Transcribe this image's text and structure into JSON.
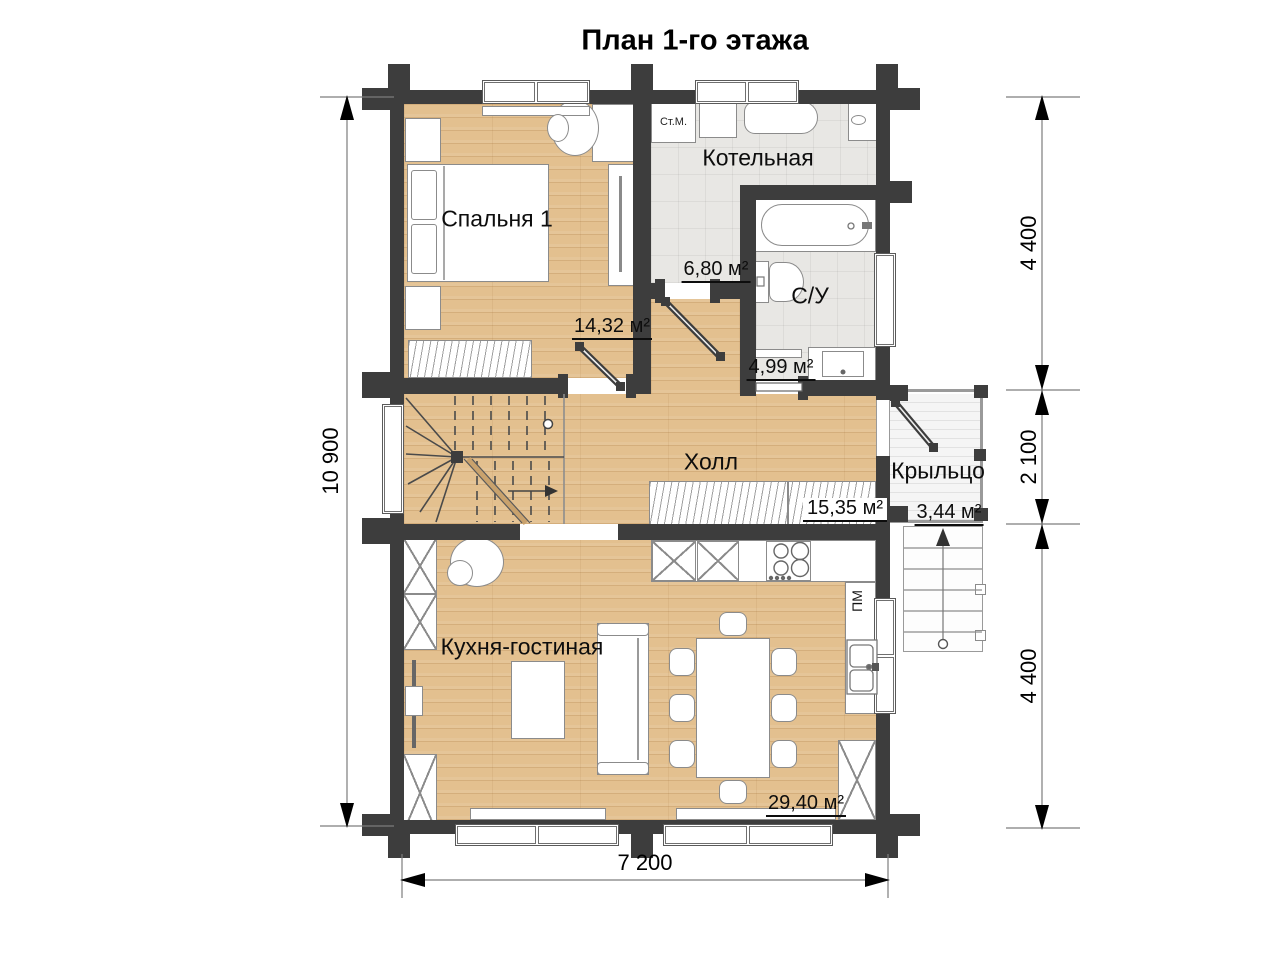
{
  "title": "План 1-го этажа",
  "rooms": [
    {
      "name": "Спальня 1",
      "area": "14,32 м²"
    },
    {
      "name": "Котельная",
      "area": "6,80 м²"
    },
    {
      "name": "С/У",
      "area": "4,99 м²"
    },
    {
      "name": "Холл",
      "area": "15,35 м²"
    },
    {
      "name": "Кухня-гостиная",
      "area": "29,40 м²"
    },
    {
      "name": "Крыльцо",
      "area": "3,44 м²"
    }
  ],
  "fixtures": {
    "washing_machine": "Ст.М.",
    "dishwasher": "ПМ"
  },
  "dimensions": {
    "left_total": "10 900",
    "right_top": "4 400",
    "right_middle": "2 100",
    "right_bottom": "4 400",
    "bottom_total": "7 200"
  },
  "colors": {
    "wall": "#3d3d3d",
    "wood_floor": "#e3c08f",
    "tile_floor": "#e8e7e4",
    "porch_floor": "#f5f5f5"
  }
}
